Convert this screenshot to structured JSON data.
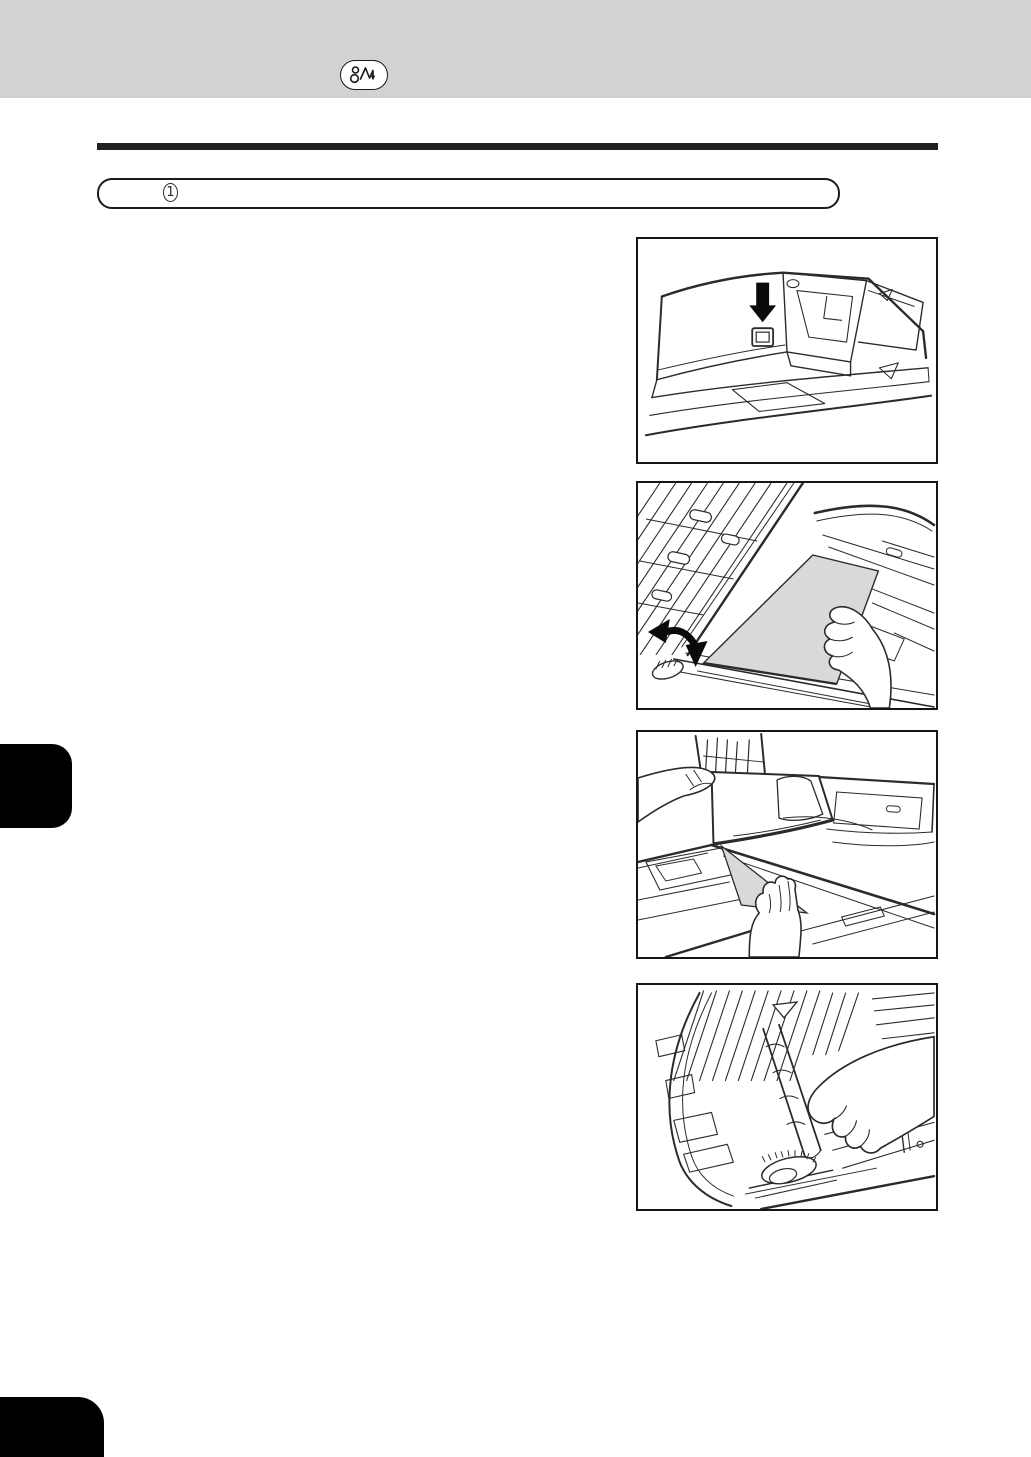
{
  "header": {
    "band_color": "#d2d2d2",
    "jam_icon": "paper-jam-icon"
  },
  "title_rule": {
    "color": "#231f20"
  },
  "step_box": {
    "number": "1"
  },
  "figures": [
    {
      "name": "press-adf-jam-release-button"
    },
    {
      "name": "open-adf-cover-remove-jammed-original"
    },
    {
      "name": "lift-adf-remove-jammed-original"
    },
    {
      "name": "turn-dial-remove-jammed-original"
    }
  ],
  "colors": {
    "line_art": "#2b2b2b",
    "paper_fill": "#d9d9d9",
    "arrow": "#0a0a0a",
    "tab": "#000000"
  }
}
